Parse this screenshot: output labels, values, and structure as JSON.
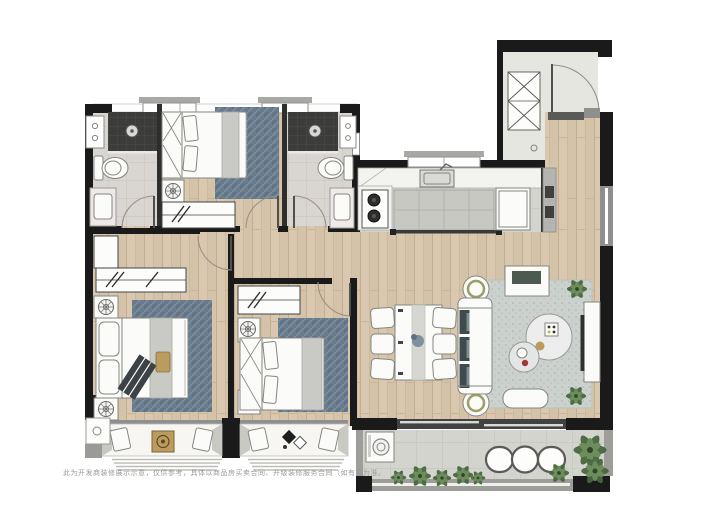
{
  "meta": {
    "kind": "apartment-floor-plan-render"
  },
  "disclaimer": "此为开发商装修展示示意，仅供参考，具体以商品房买卖合同、升级装修服务合同（如有）为准。",
  "colors": {
    "wall": "#1a1a1a",
    "window-gray": "#8f8f8f",
    "wood": "#d9c8af",
    "wood-line": "#c2af90",
    "tile": "#d4d4cf",
    "tile-line": "#c1c1ba",
    "bath-tile": "#d9d6d2",
    "shower": "#3c3c3a",
    "entry-floor": "#e4e6df",
    "rug-blue": "#687b8c",
    "rug-living": "#cbd1cc",
    "furn": "#fbfbf9",
    "furn-line": "#85857f",
    "counter": "#f3f3f0",
    "cushion": "#3e4a4c",
    "gold": "#bb9c5e",
    "plant-dark": "#47663e",
    "plant-light": "#6e8d5c",
    "door-arc": "#9a9086",
    "rail": "#9d9d9a",
    "slider": "#424242",
    "text-gray": "#9b9b9b"
  }
}
